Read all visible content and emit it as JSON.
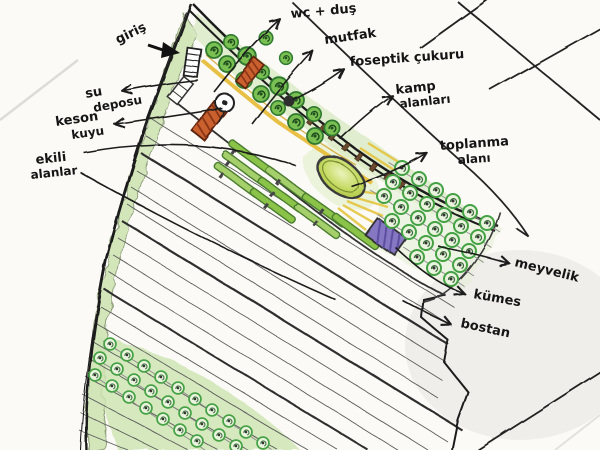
{
  "document": {
    "kind": "hand-drawn landscape site plan sketch",
    "language": "Turkish"
  },
  "labels": {
    "giris": {
      "text": "giriş"
    },
    "wc_dus": {
      "text": "wc + duş"
    },
    "mutfak": {
      "text": "mutfak"
    },
    "foseptik": {
      "text": "foseptik çukuru"
    },
    "kamp": {
      "line1": "kamp",
      "line2": "alanları"
    },
    "toplanma": {
      "line1": "toplanma",
      "line2": "alanı"
    },
    "su_deposu": {
      "line1": "su",
      "line2": "deposu"
    },
    "keson_kuyu": {
      "line1": "keson",
      "line2": "kuyu"
    },
    "ekili_alanlar": {
      "line1": "ekili",
      "line2": "alanlar"
    },
    "meyvelik": {
      "text": "meyvelik"
    },
    "kumes": {
      "text": "kümes"
    },
    "bostan": {
      "text": "bostan"
    }
  },
  "colors": {
    "paper": "#fbfaf6",
    "ink": "#1c1c1c",
    "tree_green": "#79bf52",
    "pale_tree_green": "#e9f3dd",
    "wash_green": "#d7e8c2",
    "strip_green": "#8bc34a",
    "path_yellow": "#e8bd3c",
    "building_orange": "#c9602f",
    "coop_purple": "#8577c2",
    "oval_green": "#b6d04c"
  }
}
